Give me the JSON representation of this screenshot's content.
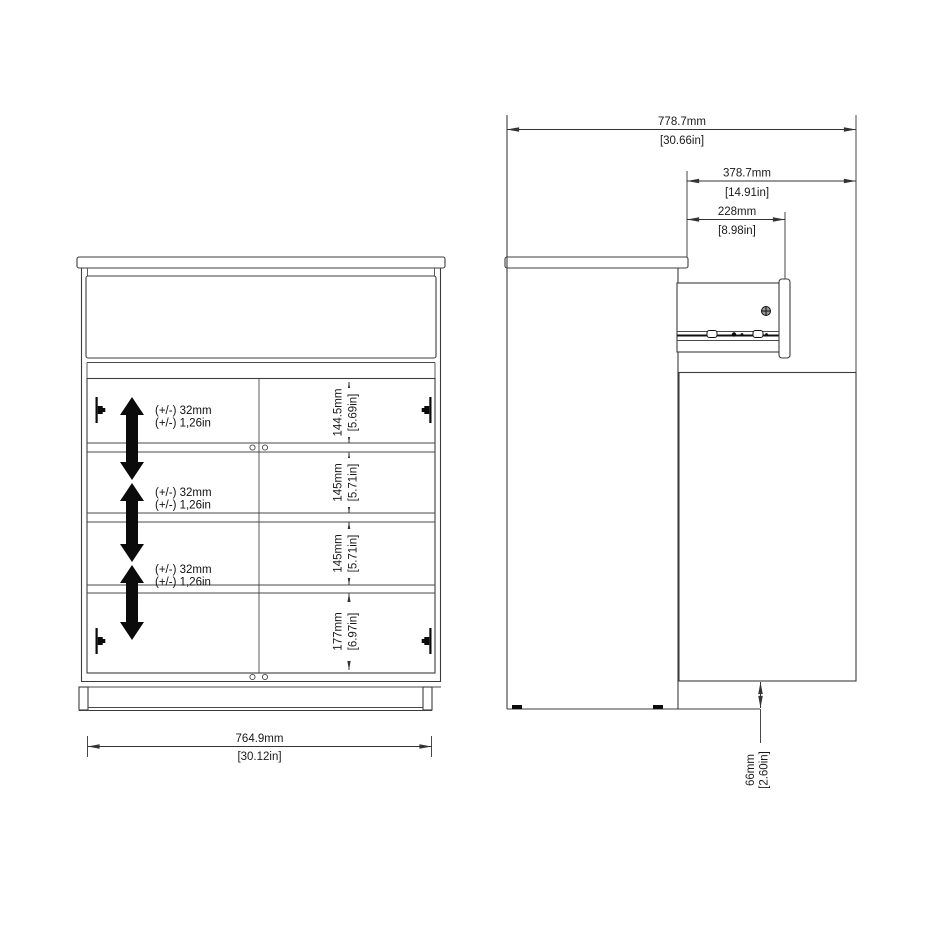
{
  "front_view": {
    "bottom_width": {
      "mm": "764.9mm",
      "inches": "[30.12in]"
    },
    "shelf_adjustability": [
      {
        "line1": "(+/-) 32mm",
        "line2": "(+/-) 1,26in"
      },
      {
        "line1": "(+/-) 32mm",
        "line2": "(+/-) 1,26in"
      },
      {
        "line1": "(+/-) 32mm",
        "line2": "(+/-) 1,26in"
      }
    ],
    "compartment_heights": [
      {
        "mm": "144.5mm",
        "inches": "[5.69in]"
      },
      {
        "mm": "145mm",
        "inches": "[5.71in]"
      },
      {
        "mm": "145mm",
        "inches": "[5.71in]"
      },
      {
        "mm": "177mm",
        "inches": "[6.97in]"
      }
    ]
  },
  "side_view": {
    "total_depth": {
      "mm": "778.7mm",
      "inches": "[30.66in]"
    },
    "open_door_depth": {
      "mm": "378.7mm",
      "inches": "[14.91in]"
    },
    "drawer_extension": {
      "mm": "228mm",
      "inches": "[8.98in]"
    },
    "door_floor_clearance": {
      "mm": "66mm",
      "inches": "[2.60in]"
    }
  },
  "colors": {
    "background": "#ffffff",
    "line": "#3d3d3d",
    "dimension": "#333333",
    "arrow_fill": "#000000"
  }
}
